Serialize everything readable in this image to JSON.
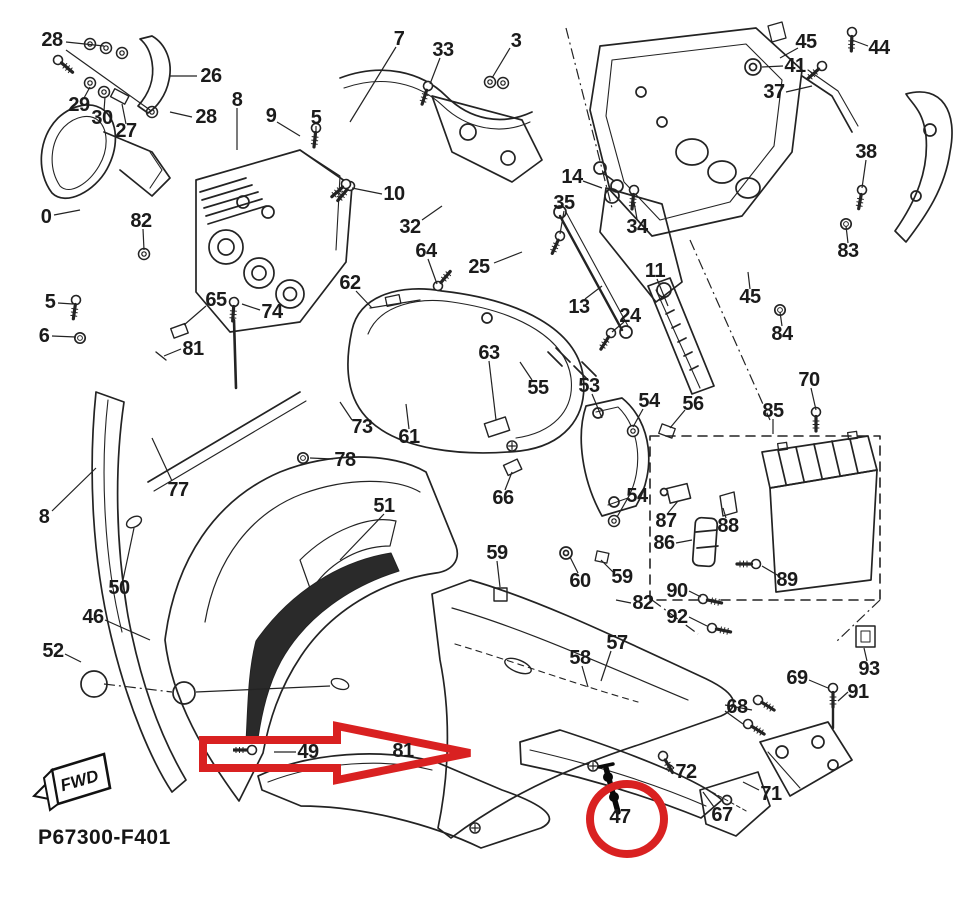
{
  "diagram": {
    "title": "motorcycle-cowling-exploded-parts-diagram",
    "highlight_color": "#d92121",
    "line_color": "#232323"
  },
  "footer": {
    "code": "P67300-F401",
    "fwd": "FWD"
  },
  "annotations": {
    "circled_part": "47",
    "arrow_points_at": "49"
  },
  "labels": [
    {
      "text": "28",
      "x": 52,
      "y": 40
    },
    {
      "text": "29",
      "x": 79,
      "y": 105
    },
    {
      "text": "30",
      "x": 102,
      "y": 118
    },
    {
      "text": "27",
      "x": 126,
      "y": 131
    },
    {
      "text": "26",
      "x": 211,
      "y": 76
    },
    {
      "text": "28",
      "x": 206,
      "y": 117
    },
    {
      "text": "8",
      "x": 237,
      "y": 100
    },
    {
      "text": "9",
      "x": 271,
      "y": 116
    },
    {
      "text": "5",
      "x": 316,
      "y": 118
    },
    {
      "text": "7",
      "x": 399,
      "y": 39
    },
    {
      "text": "33",
      "x": 443,
      "y": 50
    },
    {
      "text": "3",
      "x": 516,
      "y": 41
    },
    {
      "text": "10",
      "x": 394,
      "y": 194
    },
    {
      "text": "32",
      "x": 410,
      "y": 227
    },
    {
      "text": "64",
      "x": 426,
      "y": 251
    },
    {
      "text": "25",
      "x": 479,
      "y": 267
    },
    {
      "text": "35",
      "x": 564,
      "y": 203
    },
    {
      "text": "14",
      "x": 572,
      "y": 177
    },
    {
      "text": "34",
      "x": 637,
      "y": 227
    },
    {
      "text": "62",
      "x": 350,
      "y": 283
    },
    {
      "text": "13",
      "x": 579,
      "y": 307
    },
    {
      "text": "11",
      "x": 655,
      "y": 271
    },
    {
      "text": "24",
      "x": 630,
      "y": 316
    },
    {
      "text": "45",
      "x": 806,
      "y": 42
    },
    {
      "text": "44",
      "x": 879,
      "y": 48
    },
    {
      "text": "41",
      "x": 795,
      "y": 66
    },
    {
      "text": "37",
      "x": 774,
      "y": 92
    },
    {
      "text": "38",
      "x": 866,
      "y": 152
    },
    {
      "text": "83",
      "x": 848,
      "y": 251
    },
    {
      "text": "45",
      "x": 750,
      "y": 297
    },
    {
      "text": "84",
      "x": 782,
      "y": 334
    },
    {
      "text": "70",
      "x": 809,
      "y": 380
    },
    {
      "text": "0",
      "x": 46,
      "y": 217
    },
    {
      "text": "82",
      "x": 141,
      "y": 221
    },
    {
      "text": "5",
      "x": 50,
      "y": 302
    },
    {
      "text": "6",
      "x": 44,
      "y": 336
    },
    {
      "text": "65",
      "x": 216,
      "y": 300
    },
    {
      "text": "74",
      "x": 272,
      "y": 312
    },
    {
      "text": "81",
      "x": 193,
      "y": 349
    },
    {
      "text": "73",
      "x": 362,
      "y": 427
    },
    {
      "text": "61",
      "x": 409,
      "y": 437
    },
    {
      "text": "78",
      "x": 345,
      "y": 460
    },
    {
      "text": "77",
      "x": 178,
      "y": 490
    },
    {
      "text": "63",
      "x": 489,
      "y": 353
    },
    {
      "text": "55",
      "x": 538,
      "y": 388
    },
    {
      "text": "53",
      "x": 589,
      "y": 386
    },
    {
      "text": "54",
      "x": 649,
      "y": 401
    },
    {
      "text": "56",
      "x": 693,
      "y": 404
    },
    {
      "text": "85",
      "x": 773,
      "y": 411
    },
    {
      "text": "66",
      "x": 503,
      "y": 498
    },
    {
      "text": "87",
      "x": 666,
      "y": 521
    },
    {
      "text": "88",
      "x": 728,
      "y": 526
    },
    {
      "text": "86",
      "x": 664,
      "y": 543
    },
    {
      "text": "54",
      "x": 637,
      "y": 496
    },
    {
      "text": "51",
      "x": 384,
      "y": 506
    },
    {
      "text": "89",
      "x": 787,
      "y": 580
    },
    {
      "text": "59",
      "x": 497,
      "y": 553
    },
    {
      "text": "60",
      "x": 580,
      "y": 581
    },
    {
      "text": "59",
      "x": 622,
      "y": 577
    },
    {
      "text": "90",
      "x": 677,
      "y": 591
    },
    {
      "text": "82",
      "x": 643,
      "y": 603
    },
    {
      "text": "92",
      "x": 677,
      "y": 617
    },
    {
      "text": "93",
      "x": 869,
      "y": 669
    },
    {
      "text": "8",
      "x": 44,
      "y": 517
    },
    {
      "text": "50",
      "x": 119,
      "y": 588
    },
    {
      "text": "46",
      "x": 93,
      "y": 617
    },
    {
      "text": "52",
      "x": 53,
      "y": 651
    },
    {
      "text": "69",
      "x": 797,
      "y": 678
    },
    {
      "text": "91",
      "x": 858,
      "y": 692
    },
    {
      "text": "58",
      "x": 580,
      "y": 658
    },
    {
      "text": "57",
      "x": 617,
      "y": 643
    },
    {
      "text": "68",
      "x": 737,
      "y": 707
    },
    {
      "text": "49",
      "x": 308,
      "y": 752
    },
    {
      "text": "81",
      "x": 403,
      "y": 751
    },
    {
      "text": "72",
      "x": 686,
      "y": 772
    },
    {
      "text": "67",
      "x": 722,
      "y": 815
    },
    {
      "text": "71",
      "x": 771,
      "y": 794
    },
    {
      "text": "47",
      "x": 620,
      "y": 817
    }
  ]
}
